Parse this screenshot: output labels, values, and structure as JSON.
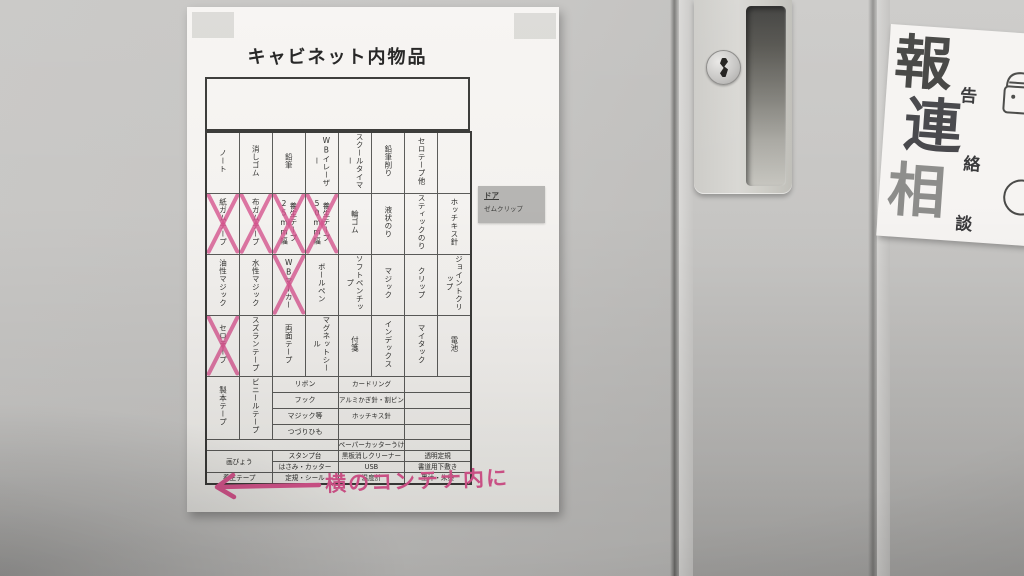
{
  "paper": {
    "title": "キャビネット内物品",
    "handwriting": "横のコンテナ内に",
    "sticky_note": {
      "title": "ドア",
      "item": "ゼムクリップ"
    },
    "table": {
      "header": [
        "ノート",
        "消しゴム",
        "鉛筆",
        "WBイレーザー",
        "スクールタイマー",
        "鉛筆削り",
        "セロテープ他",
        ""
      ],
      "rows": [
        [
          "紙ガムテープ",
          "布ガムテープ",
          "養生テープ25mm幅",
          "養生テープ50mm幅",
          "輪ゴム",
          "液状のり",
          "スティックのり",
          "ホッチキス針"
        ],
        [
          "油性マジック",
          "水性マジック",
          "WBマーカー",
          "ボールペン",
          "ソフトペンチップ",
          "マジック",
          "クリップ",
          "ジョイントクリップ"
        ],
        [
          "セロテープ",
          "スズランテープ",
          "両面テープ",
          "マグネットシール",
          "付箋",
          "インデックス",
          "マイタック",
          "電池"
        ]
      ],
      "row5": {
        "c1": "製本テープ",
        "c2": "ビニールテープ",
        "left_list": [
          "リボン",
          "フック",
          "マジック等",
          "つづりひも"
        ],
        "right_list": [
          "カードリング",
          "アルミかぎ針・割ピン",
          "ホッチキス針",
          ""
        ]
      },
      "bottom": {
        "rowA": {
          "c3": "ペーパーカッターうけ"
        },
        "rowB": {
          "c1": "画びょう",
          "c2": "スタンプ台",
          "c3": "黒板消しクリーナー",
          "c4": "透明定規"
        },
        "rowC": {
          "c2": "はさみ・カッター",
          "c3": "USB",
          "c4": "書道用下敷き"
        },
        "rowD": {
          "c1": "養生テープ",
          "c2": "定規・シール",
          "c3": "温度計",
          "c4": "墨汁・朱墨"
        }
      },
      "crossed_out": [
        "紙ガムテープ",
        "布ガムテープ",
        "養生テープ25mm幅",
        "養生テープ50mm幅",
        "WBマーカー",
        "セロテープ"
      ]
    }
  },
  "sign": {
    "items": [
      {
        "large": "報",
        "small": "告"
      },
      {
        "large": "連",
        "small": "絡"
      },
      {
        "large": "相",
        "small": "談"
      }
    ]
  },
  "colors": {
    "highlight_pink": "#d6558f",
    "cabinet_gray": "#c6c5c3",
    "paper_white": "#f4f2ef",
    "sticky_gray": "#b6b5b3"
  }
}
